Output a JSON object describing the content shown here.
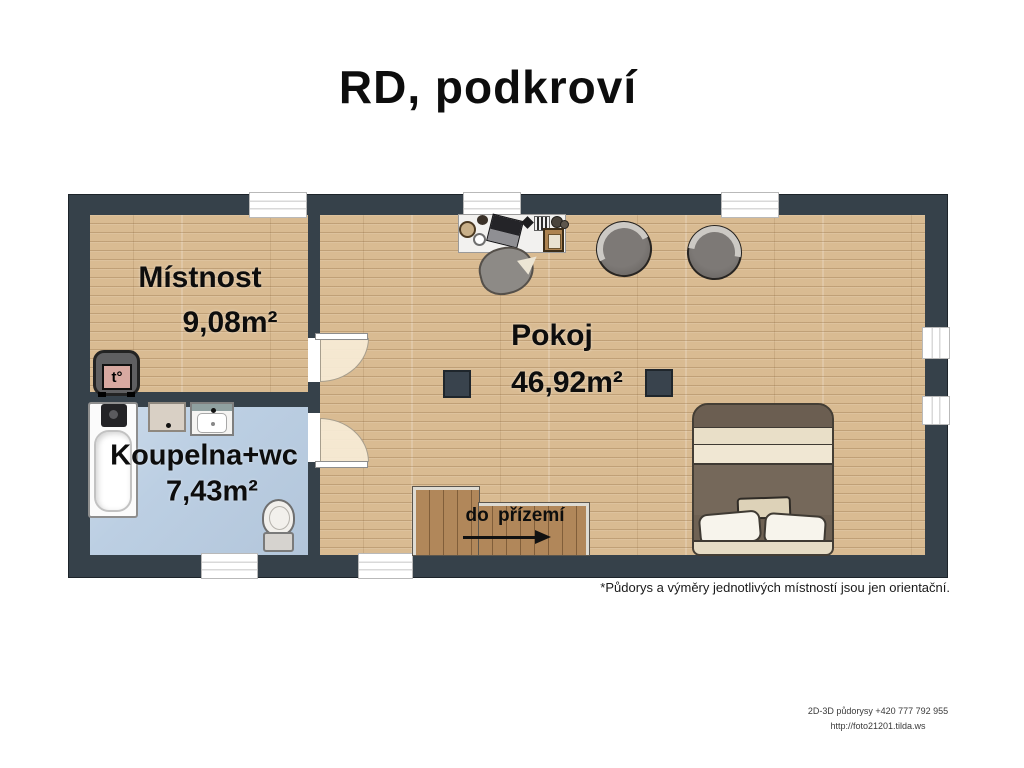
{
  "title": "RD, podkroví",
  "rooms": {
    "mistnost": {
      "name": "Místnost",
      "area": "9,08m²"
    },
    "pokoj": {
      "name": "Pokoj",
      "area": "46,92m²"
    },
    "koupelna": {
      "name": "Koupelna+wc",
      "area": "7,43m²"
    }
  },
  "stairs": {
    "label": "do přízemí",
    "direction": "right"
  },
  "stove_label": "t°",
  "footnote": "*Půdorys a výměry jednotlivých místností jsou jen orientační.",
  "credits": {
    "phone_line": "2D-3D půdorysy +420 777 792 955",
    "url_line": "http://foto21201.tilda.ws"
  },
  "furniture": [
    "bed",
    "armchair",
    "armchair",
    "desk",
    "desk-chair",
    "stove",
    "bathtub",
    "washer",
    "sink",
    "toilet"
  ],
  "colors": {
    "wall": "#36414a",
    "wood_floor": "#d9bb92",
    "bath_floor": "#bccfe3",
    "stairs_wood": "#b1875a",
    "text": "#0d0d0d"
  }
}
